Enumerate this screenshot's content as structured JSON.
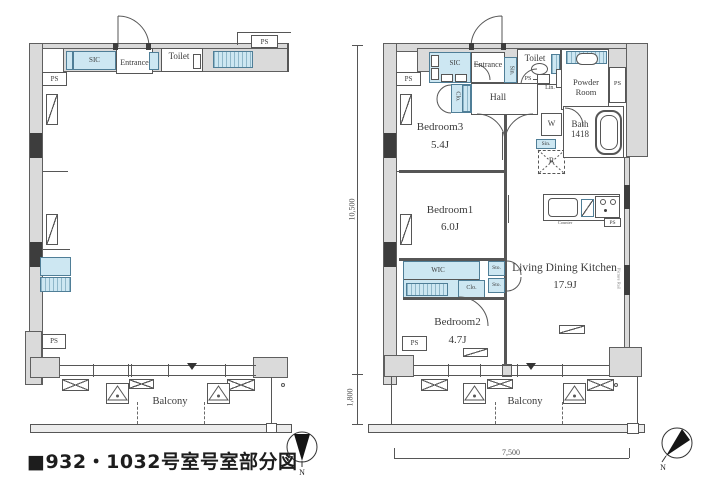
{
  "title": "■932・1032号室号室部分図",
  "shared": {
    "ps": "PS",
    "balcony": "Balcony",
    "north": "N",
    "sic": "SIC",
    "entrance": "Entrance",
    "toilet": "Toilet",
    "sin": "Sin.",
    "sto": "Sto.",
    "clo": "Clo.",
    "lin": "Lin."
  },
  "dimensions": {
    "depth_main": "10,500",
    "depth_balcony": "1,800",
    "width": "7,500"
  },
  "right_plan": {
    "hall": "Hall",
    "powder_room": "Powder\nRoom",
    "washer": "W",
    "bath": "Bath",
    "bath_size": "1418",
    "fridge": "R",
    "bedroom3": "Bedroom3",
    "bedroom3_size": "5.4J",
    "bedroom1": "Bedroom1",
    "bedroom1_size": "6.0J",
    "bedroom2": "Bedroom2",
    "bedroom2_size": "4.7J",
    "wic": "WIC",
    "ldk": "Living Dining Kitchen",
    "ldk_size": "17.9J",
    "counter": "Counter",
    "picture_rail": "Picture Rail"
  }
}
